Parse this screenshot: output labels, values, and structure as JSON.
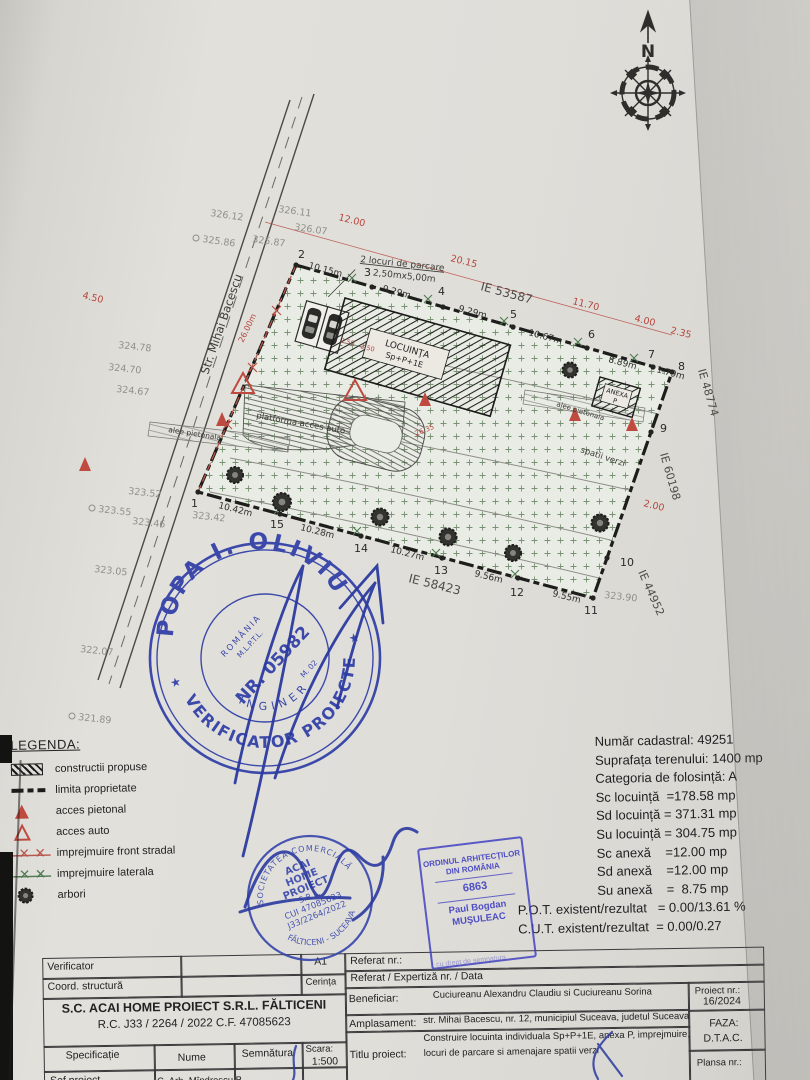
{
  "compass": {
    "north_label": "N"
  },
  "plan": {
    "street_name": "Str. Mihai Bacescu",
    "house_label": "LOCUINŢA",
    "house_regime": "Sp+P+1E",
    "annex_label": "ANEXA",
    "annex_regime": "P",
    "parking_title": "2 locuri de parcare",
    "parking_size": "2,50mx5,00m",
    "platform_label": "platforma acces auto",
    "walkway_label_1": "alee pietonala",
    "walkway_label_2": "alee pietonala",
    "green_label": "spatii verzi",
    "parcels": {
      "top": "IE 53587",
      "right_upper": "IE 48774",
      "right_lower": "IE 60198",
      "bottom_right": "IE 44952",
      "bottom": "IE 58423"
    },
    "red_dims": {
      "street_front": "12.00",
      "d1": "20.15",
      "d2": "11.70",
      "d3": "4.00",
      "d4": "2.35",
      "d5": "4.50",
      "d6": "2.00",
      "d7": "26.00m",
      "d8": "26.35",
      "d9": "2.50",
      "d10": "2.50"
    },
    "top_dims": [
      "10.15m",
      "9.29m",
      "9.29m",
      "10.67m",
      "8.89m",
      "1.79m"
    ],
    "bottom_dims": [
      "10.42m",
      "10.28m",
      "10.27m",
      "9.56m",
      "9.55m"
    ],
    "points": [
      "1",
      "2",
      "3",
      "4",
      "5",
      "6",
      "7",
      "8",
      "9",
      "10",
      "11",
      "12",
      "13",
      "14",
      "15"
    ],
    "elevations": [
      "326.12",
      "326.11",
      "326.07",
      "325.86",
      "325.87",
      "324.78",
      "324.70",
      "324.67",
      "323.52",
      "323.55",
      "323.46",
      "323.42",
      "323.05",
      "322.07",
      "321.89",
      "323.90"
    ]
  },
  "legend": {
    "title": "LEGENDA:",
    "items": [
      "constructii propuse",
      "limita proprietate",
      "acces pietonal",
      "acces auto",
      "imprejmuire front stradal",
      "imprejmuire laterala",
      "arbori"
    ]
  },
  "site_info": {
    "rows": [
      "Număr cadastral: 49251",
      "Suprafața terenului: 1400 mp",
      "Categoria de folosință: A",
      "Sc locuință  =178.58 mp",
      "Sd locuință = 371.31 mp",
      "Su locuință = 304.75 mp",
      "Sc anexă    =12.00 mp",
      "Sd anexă    =12.00 mp",
      "Su anexă    =  8.75 mp"
    ],
    "pot": "P.O.T. existent/rezultat   = 0.00/13.61 %",
    "cut": "C.U.T. existent/rezultat  = 0.00/0.27"
  },
  "stamps": {
    "verifier_round": {
      "top_arc": "POPA I. OLIVIU",
      "bottom_arc": "VERIFICATOR PROIECTE",
      "inner_arc": "INGINER",
      "center_line1": "ROMÂNIA",
      "center_line2": "M.L.P.T.L.",
      "number": "NR. 05982",
      "center_line3": "M. 02",
      "star": "★"
    },
    "company_round": {
      "top_arc": "SOCIETATEA COMERCIALĂ",
      "center_lines": [
        "ACAI",
        "HOME",
        "PROIECT",
        "S.R.L.",
        "CUI 47085623",
        "J33/2264/2022"
      ],
      "bottom_arc": "FĂLTICENI - SUCEAVA"
    },
    "architect": {
      "line1": "ORDINUL ARHITECŢILOR",
      "line2": "DIN ROMÂNIA",
      "number": "6863",
      "name_first": "Paul Bogdan",
      "name_last": "MUŞULEAC",
      "fragment": "cu drept de semnatura"
    }
  },
  "title_block": {
    "verificator": "Verificator",
    "coord": "Coord. structură",
    "a1": "A1",
    "cerinta": "Cerința",
    "referat": "Referat nr.:",
    "expertiza": "Referat / Expertiză nr. / Data",
    "beneficiar_label": "Beneficiar:",
    "beneficiar": "Cuciureanu Alexandru Claudiu si Cuciureanu Sorina",
    "company_line1": "S.C.  ACAI HOME PROIECT  S.R.L. FĂLTICENI",
    "company_line2": "R.C.  J33 / 2264 / 2022    C.F. 47085623",
    "specificatie": "Specificație",
    "nume": "Nume",
    "semnatura": "Semnătura",
    "scara_label": "Scara:",
    "scara": "1:500",
    "sef_proiect": "Șef proiect",
    "sef_name": "C. Arh. Mîndrescu B.",
    "amplasament_label": "Amplasament:",
    "amplasament": "str. Mihai Bacescu, nr. 12, municipiul Suceava, judetul Suceava",
    "titlu_label": "Titlu proiect:",
    "titlu_line1": "Construire locuinta individuala Sp+P+1E, anexa P, imprejmuire,",
    "titlu_line2": "locuri de parcare si amenajare spatii verzi",
    "proiect_label": "Proiect nr.:",
    "proiect": "16/2024",
    "faza_label": "FAZA:",
    "faza": "D.T.A.C.",
    "plansa_label": "Plansa nr.:"
  }
}
